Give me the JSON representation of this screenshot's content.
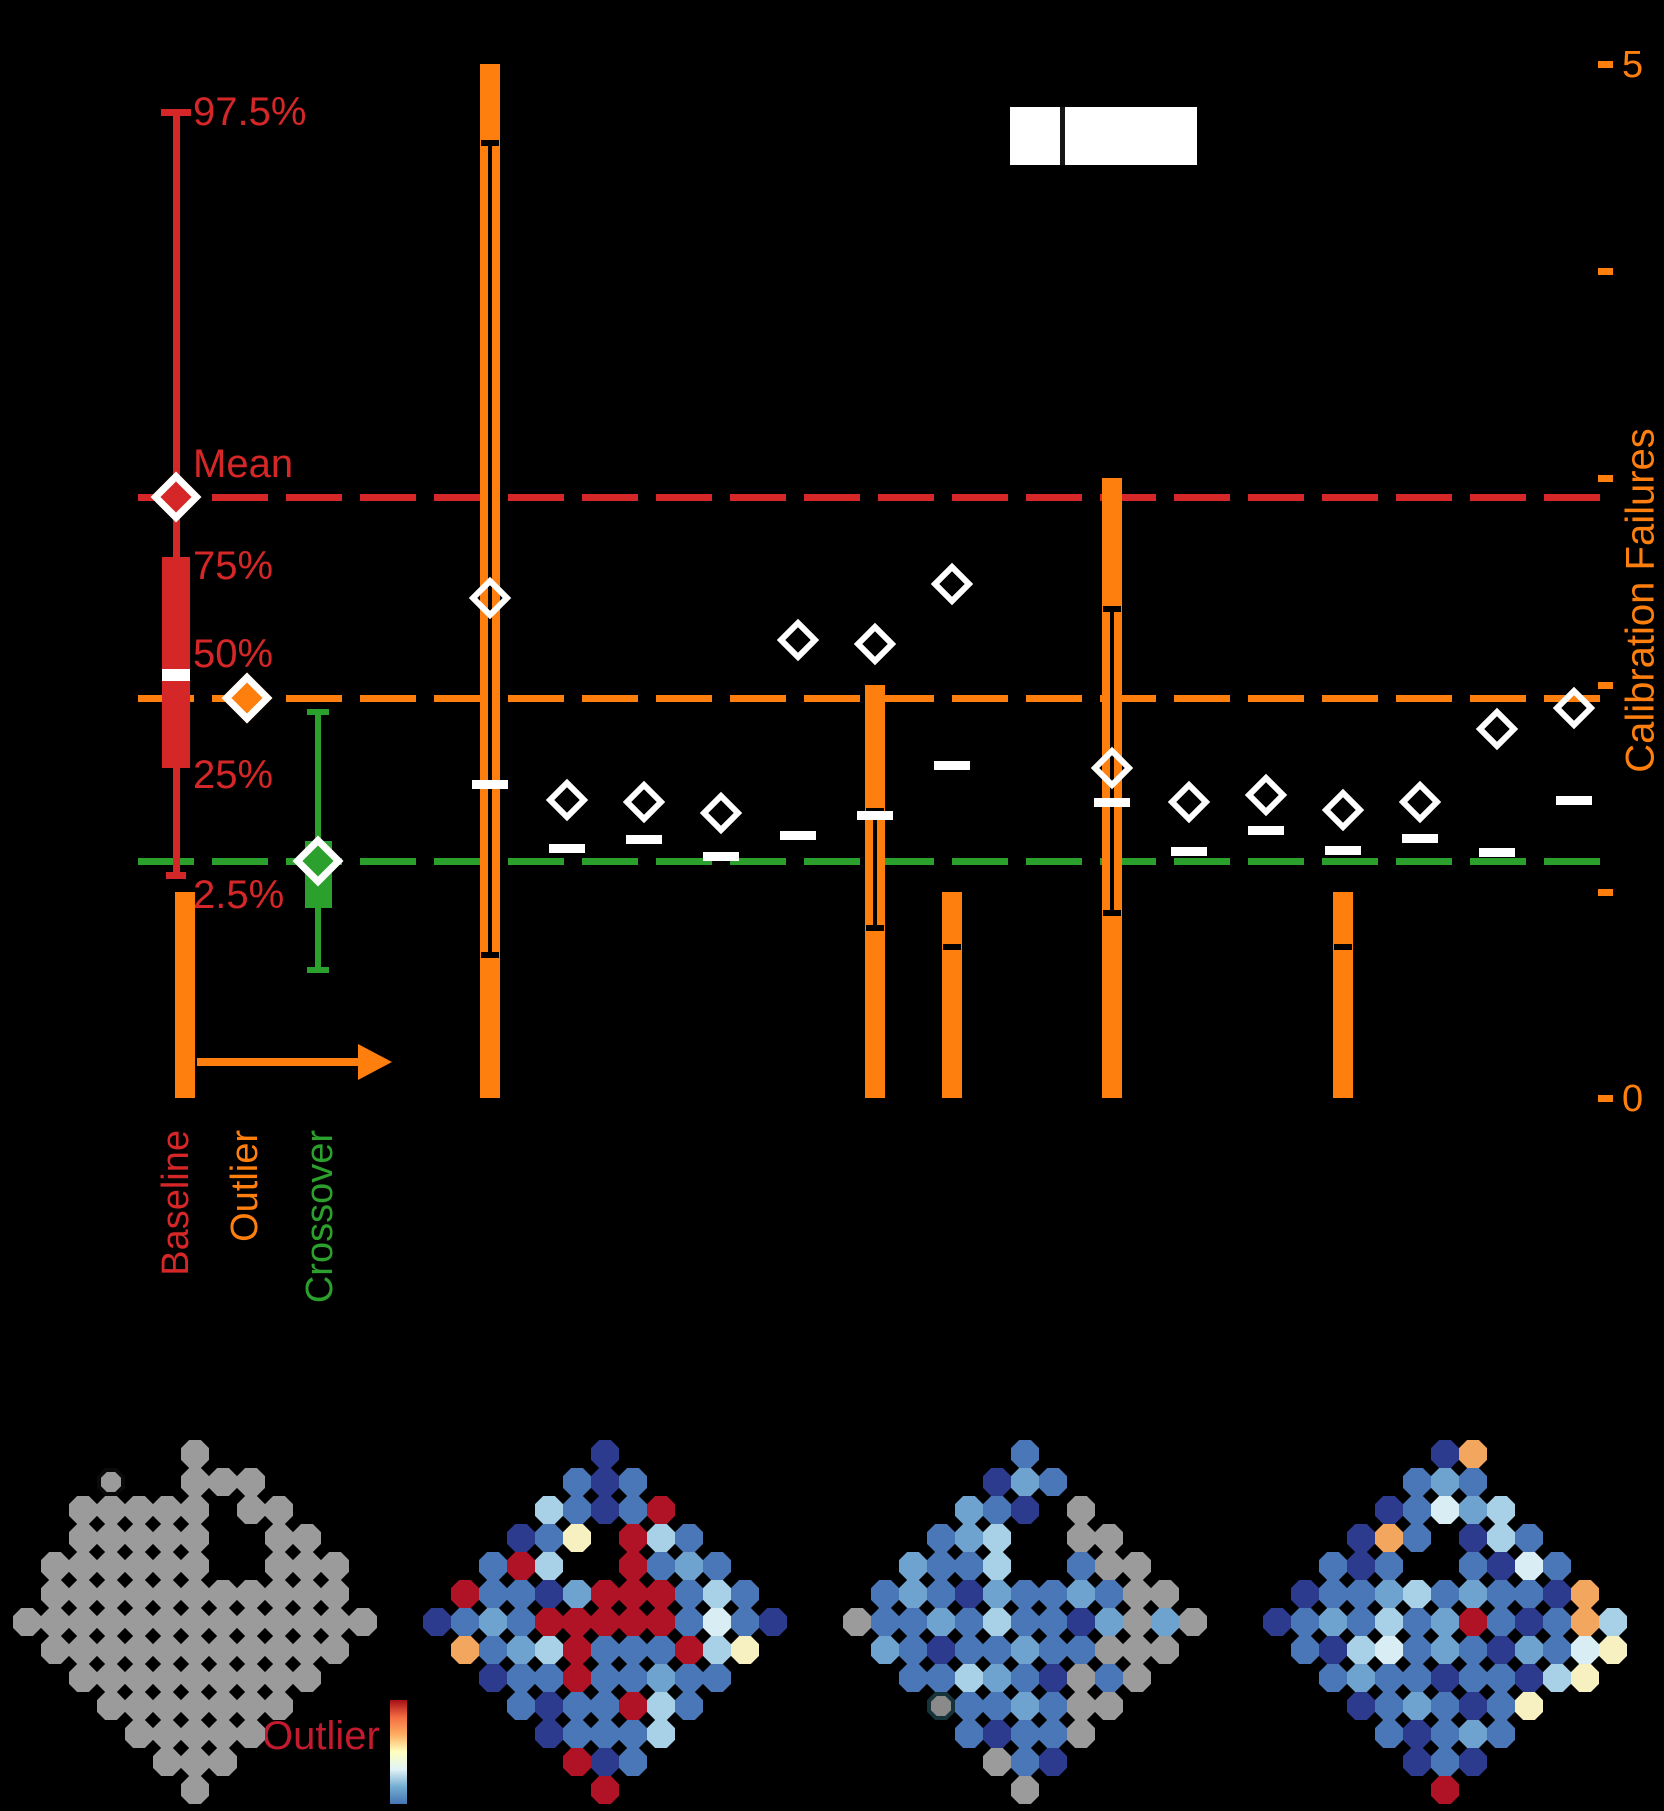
{
  "figure": {
    "bg": "#000000",
    "width": 1664,
    "height": 1811
  },
  "right_axis": {
    "title": "Calibration Failures",
    "color": "#ff7f0e",
    "tick_x": 1598,
    "tick_ys": [
      64,
      271,
      478,
      685,
      892,
      1098
    ],
    "top_label": "5",
    "bottom_label": "0",
    "range": [
      0,
      5
    ]
  },
  "ref_lines": [
    {
      "name": "mean-line",
      "color": "#d62728",
      "y": 497
    },
    {
      "name": "median-line",
      "color": "#ff7f0e",
      "y": 698
    },
    {
      "name": "lower-line",
      "color": "#2ca02c",
      "y": 861
    }
  ],
  "legend_box": {
    "x": 1010,
    "y": 107,
    "width": 187,
    "height": 58,
    "divider_x": 1060,
    "fill": "#ffffff"
  },
  "boxplot_legend": {
    "labels": {
      "p975": "97.5%",
      "mean": "Mean",
      "p75": "75%",
      "p50": "50%",
      "p25": "25%",
      "p025": "2.5%"
    },
    "red": {
      "color": "#d62728",
      "line_x": 176,
      "whisker_top": 112,
      "whisker_bottom": 875,
      "box_left": 162,
      "box_width": 28,
      "box_top": 557,
      "box_bottom": 768,
      "median_y": 675,
      "mean_y": 497
    },
    "orange_diamond": {
      "color": "#ff7f0e",
      "x": 247,
      "y": 698
    },
    "green": {
      "color": "#2ca02c",
      "line_x": 318,
      "whisker_top": 712,
      "whisker_bottom": 970,
      "box_left": 305,
      "box_width": 27,
      "box_top": 841,
      "box_bottom": 908,
      "diamond_y": 861
    }
  },
  "group_labels": [
    {
      "label": "Baseline",
      "color": "#d62728",
      "x": 176
    },
    {
      "label": "Outlier",
      "color": "#ff7f0e",
      "x": 245
    },
    {
      "label": "Crossover",
      "color": "#2ca02c",
      "x": 320
    }
  ],
  "arrow": {
    "color": "#ff7f0e",
    "y": 1062,
    "x_start": 197,
    "x_end": 358,
    "head_len": 34
  },
  "chart_data": {
    "type": "bar",
    "title": "",
    "ylabel_right": "Calibration Failures",
    "right_axis_range": [
      0,
      5
    ],
    "y0_px": 1098,
    "px_per_unit": 206.8,
    "bar_color": "#ff7f0e",
    "bar_width": 20,
    "marker_color": "#ffffff",
    "baseline_bar": {
      "x": 185,
      "failures": 1,
      "top_px": 892,
      "err_ticks": []
    },
    "columns": [
      {
        "x": 490,
        "diamond_y": 598,
        "dash_y": 784,
        "failures": 5,
        "top_px": 64,
        "err_ticks": [
          143,
          955
        ]
      },
      {
        "x": 567,
        "diamond_y": 800,
        "dash_y": 848
      },
      {
        "x": 644,
        "diamond_y": 802,
        "dash_y": 839
      },
      {
        "x": 721,
        "diamond_y": 813,
        "dash_y": 856
      },
      {
        "x": 798,
        "diamond_y": 640,
        "dash_y": 835
      },
      {
        "x": 875,
        "diamond_y": 644,
        "dash_y": 815,
        "failures": 2,
        "top_px": 685,
        "err_ticks": [
          811,
          928
        ]
      },
      {
        "x": 952,
        "diamond_y": 584,
        "dash_y": 765,
        "failures": 1,
        "top_px": 892,
        "err_ticks": [
          947
        ]
      },
      {
        "x": 1112,
        "diamond_y": 768,
        "dash_y": 802,
        "failures": 3,
        "top_px": 478,
        "err_ticks": [
          609,
          913
        ]
      },
      {
        "x": 1189,
        "diamond_y": 802,
        "dash_y": 851
      },
      {
        "x": 1266,
        "diamond_y": 795,
        "dash_y": 830
      },
      {
        "x": 1343,
        "diamond_y": 810,
        "dash_y": 850,
        "failures": 1,
        "top_px": 892,
        "err_ticks": [
          947
        ]
      },
      {
        "x": 1420,
        "diamond_y": 802,
        "dash_y": 838
      },
      {
        "x": 1497,
        "diamond_y": 729,
        "dash_y": 852
      },
      {
        "x": 1574,
        "diamond_y": 708,
        "dash_y": 800
      }
    ]
  },
  "heatmaps": {
    "cell": 28,
    "top": 1440,
    "lefts": [
      13,
      423,
      843,
      1263
    ],
    "palette": {
      "g": "#9b9b9b",
      "n": "#2d3b8e",
      "d": "#24317e",
      "b": "#4a77b8",
      "s": "#6fa3cf",
      "l": "#a8d0e6",
      "p": "#d9edf5",
      "c": "#f7f0c0",
      "w": "#eef4df",
      "o": "#f2a65e",
      "r": "#b01226",
      "G": {
        "fill": "#9b9b9b",
        "outline": "#0a0a0a"
      },
      "D": {
        "fill": "#8a8a8a",
        "outline": "#16333a"
      }
    },
    "colorbar": {
      "label": "Outlier",
      "label_color": "#c21a2e",
      "x": 390,
      "y": 1700,
      "width": 17,
      "height": 104,
      "gradient": [
        "#a50f15",
        "#f46d43",
        "#fdae61",
        "#ffffbf",
        "#e0f3f8",
        "#74add1",
        "#4575b4"
      ]
    },
    "maps": [
      {
        "name": "map-baseline",
        "rows": [
          "......g......",
          "...G..ggg....",
          "..ggggg.gg...",
          "..ggggg..gg..",
          ".gggggg..ggg.",
          ".ggggggggggg.",
          "ggggggggggggg",
          ".ggggggggggg.",
          "..ggggggggg..",
          "...ggggggg...",
          "....ggggg....",
          ".....ggg.....",
          "......g......"
        ]
      },
      {
        "name": "map-outlier",
        "rows": [
          "......n......",
          ".....bnb.....",
          "....lbnbr....",
          "...nbc.rlb...",
          "..brl..rbsb..",
          ".rbbnsrrrblb.",
          "nbsbrrrrrbpbn",
          ".obslrbbbrlc.",
          "..nbbrbbsbb..",
          "...bnbbrlb...",
          "....nbbbl....",
          ".....rnb.....",
          "......r......"
        ]
      },
      {
        "name": "map-crossover",
        "rows": [
          "......b......",
          ".....nsb.....",
          "....sbn.g....",
          "...bsl..gg...",
          "..sbbl..bgg..",
          ".bsbnsbbsbgg.",
          "gbbsblbbnsgsg",
          ".sbnbbsbbggg.",
          "..bblsbngbg..",
          "...Dbbsbgg...",
          "....bnbbg....",
          ".....gbn.....",
          "......g......"
        ]
      },
      {
        "name": "map-fourth",
        "rows": [
          "......no.....",
          ".....bsb.....",
          "....nbpsl....",
          "...nob.nlb...",
          "..bnb..bnpb..",
          ".nbbslbsbbno.",
          "nbsblbsrbnbol",
          ".bnlpbsbnsbpc",
          "..bsbbnbbnlc.",
          "...nbsbnbc...",
          "....bnbsb....",
          ".....nbn.....",
          "......r......"
        ]
      }
    ]
  }
}
